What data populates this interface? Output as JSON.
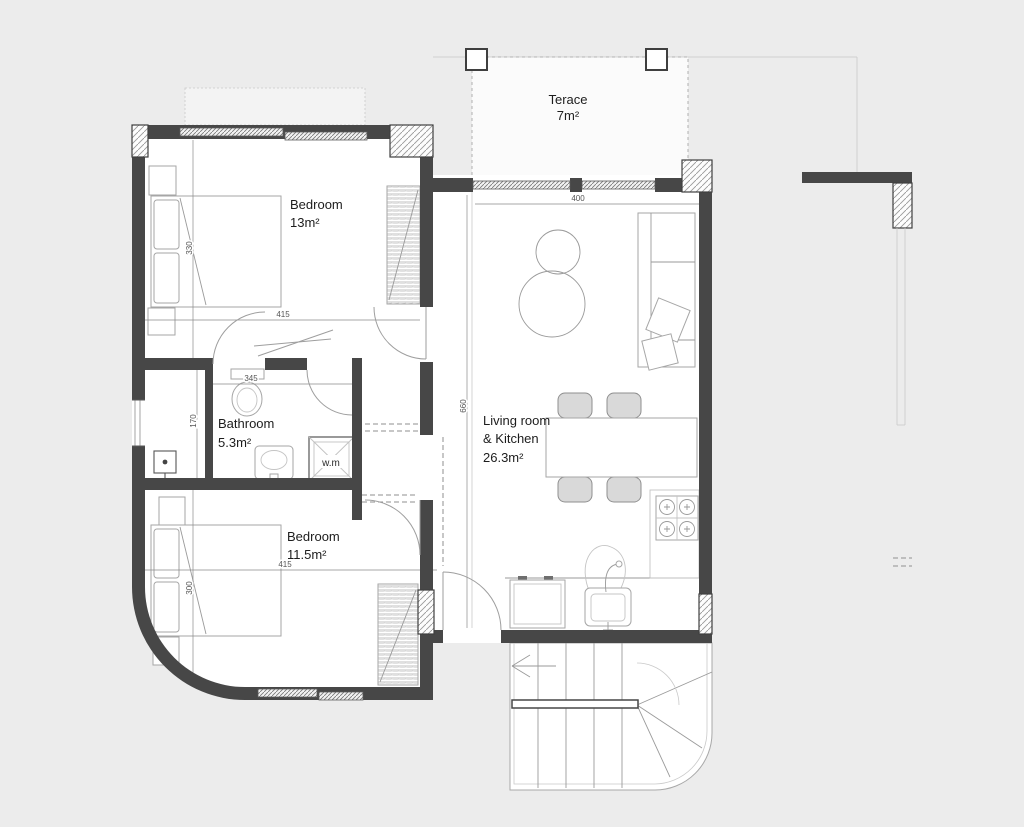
{
  "title": "apartment-floor-plan",
  "colors": {
    "background": "#ececec",
    "plan_fill": "#ffffff",
    "wall": "#474747",
    "thin_line": "#9a9a9a",
    "dim_text": "#555555",
    "label_text": "#1d1d1d"
  },
  "rooms": {
    "terrace": {
      "label": "Terace",
      "area": "7m²"
    },
    "bedroom_top": {
      "label": "Bedroom",
      "area": "13m²"
    },
    "bathroom": {
      "label": "Bathroom",
      "area": "5.3m²"
    },
    "bedroom_bottom": {
      "label": "Bedroom",
      "area": "11.5m²"
    },
    "living_kitchen": {
      "label_line1": "Living room",
      "label_line2": "& Kitchen",
      "area": "26.3m²"
    },
    "washing_machine": {
      "label": "w.m"
    }
  },
  "dimensions": {
    "living_width": "400",
    "living_height": "660",
    "bedroom_top_width": "415",
    "bedroom_top_height": "330",
    "bedroom_bottom_width": "415",
    "bedroom_bottom_height": "300",
    "hall_height": "170",
    "bathroom_width": "345"
  }
}
